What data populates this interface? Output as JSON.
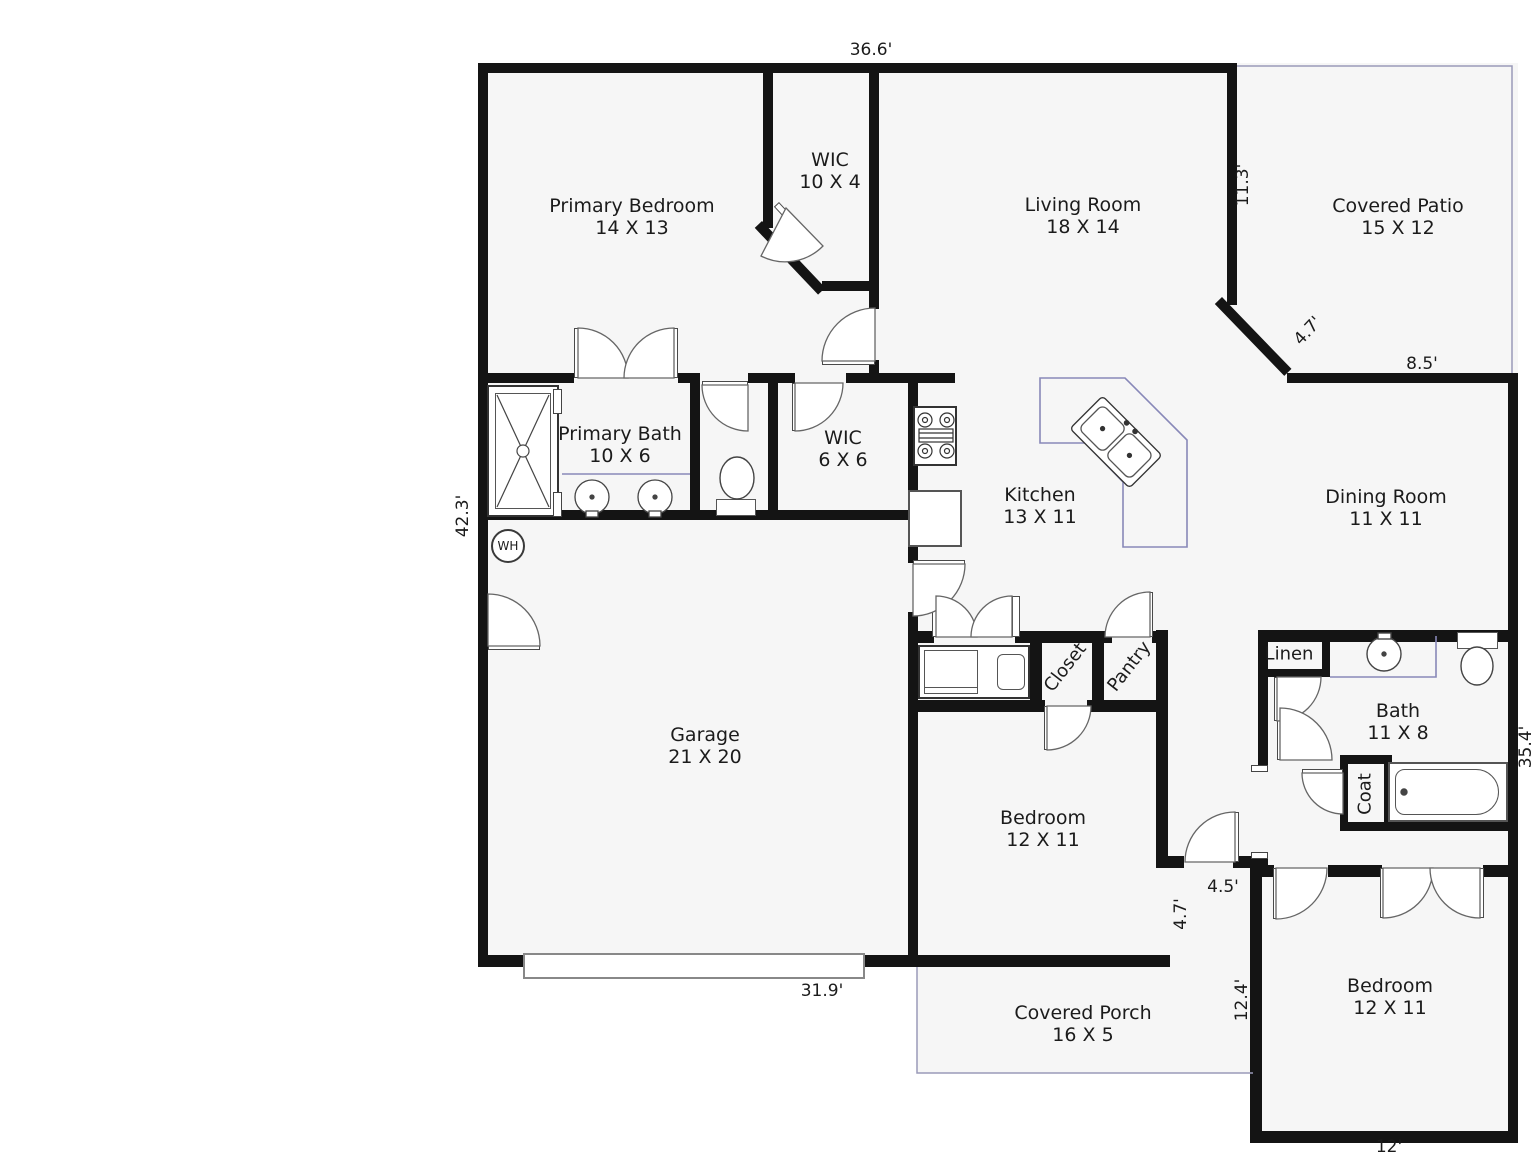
{
  "plan_title": "Single-story house floor plan",
  "rooms": [
    {
      "name": "Primary Bedroom",
      "dims": "14 X 13"
    },
    {
      "name": "WIC",
      "dims": "10 X 4"
    },
    {
      "name": "Living Room",
      "dims": "18 X 14"
    },
    {
      "name": "Covered Patio",
      "dims": "15 X 12"
    },
    {
      "name": "Primary Bath",
      "dims": "10 X 6"
    },
    {
      "name": "WIC",
      "dims": "6 X 6"
    },
    {
      "name": "Kitchen",
      "dims": "13 X 11"
    },
    {
      "name": "Dining Room",
      "dims": "11 X 11"
    },
    {
      "name": "Garage",
      "dims": "21 X 20"
    },
    {
      "name": "Bedroom",
      "dims": "12 X 11"
    },
    {
      "name": "Bedroom",
      "dims": "12 X 11"
    },
    {
      "name": "Covered Porch",
      "dims": "16 X 5"
    },
    {
      "name": "Bath",
      "dims": "11 X 8"
    }
  ],
  "closets": {
    "closet": "Closet",
    "pantry": "Pantry",
    "linen": "Linen",
    "coat": "Coat"
  },
  "appliances": {
    "water_heater": "WH"
  },
  "dimensions": {
    "top": "36.6'",
    "patio_left": "11.3'",
    "patio_diag": "4.7'",
    "patio_bottom": "8.5'",
    "left": "42.3'",
    "right": "35.4'",
    "bottom": "31.9'",
    "hall_width": "4.5'",
    "hall_side": "4.7'",
    "porch_side": "12.4'",
    "bedroom_bottom": "12'"
  },
  "colors": {
    "wall": "#141414",
    "floor": "#f6f6f6",
    "counter_line": "#8888b8",
    "porch_line": "#9a9ab8"
  }
}
